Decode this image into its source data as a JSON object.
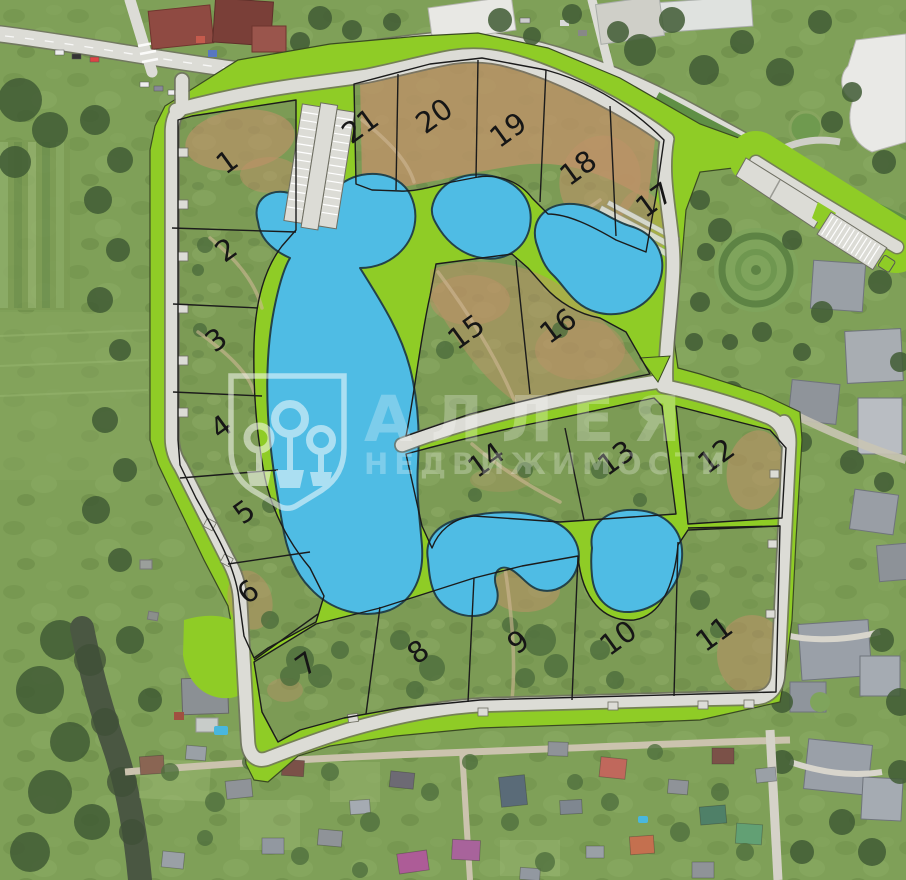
{
  "map": {
    "watermark": {
      "title": "АЛЛЕЯ",
      "subtitle": "НЕДВИЖИМОСТИ",
      "logo": "alleya-shield-trees-icon"
    },
    "number_rotation_deg": -36,
    "lots": [
      {
        "number": "1",
        "x": 233,
        "y": 170
      },
      {
        "number": "2",
        "x": 232,
        "y": 258
      },
      {
        "number": "3",
        "x": 222,
        "y": 348
      },
      {
        "number": "4",
        "x": 227,
        "y": 435
      },
      {
        "number": "5",
        "x": 250,
        "y": 520
      },
      {
        "number": "6",
        "x": 254,
        "y": 600
      },
      {
        "number": "7",
        "x": 312,
        "y": 672
      },
      {
        "number": "8",
        "x": 424,
        "y": 660
      },
      {
        "number": "9",
        "x": 524,
        "y": 650
      },
      {
        "number": "10",
        "x": 624,
        "y": 646
      },
      {
        "number": "11",
        "x": 720,
        "y": 642
      },
      {
        "number": "12",
        "x": 722,
        "y": 464
      },
      {
        "number": "13",
        "x": 622,
        "y": 466
      },
      {
        "number": "14",
        "x": 492,
        "y": 468
      },
      {
        "number": "15",
        "x": 472,
        "y": 340
      },
      {
        "number": "16",
        "x": 564,
        "y": 334
      },
      {
        "number": "17",
        "x": 660,
        "y": 208
      },
      {
        "number": "18",
        "x": 584,
        "y": 176
      },
      {
        "number": "19",
        "x": 514,
        "y": 138
      },
      {
        "number": "20",
        "x": 440,
        "y": 124
      },
      {
        "number": "21",
        "x": 366,
        "y": 134
      }
    ],
    "colors": {
      "pond": "#4FBCE4",
      "greenway": "#8FCC26",
      "road": "#DCDCD6",
      "lot_line": "#1B1B1B",
      "terrain": "#7C9B55",
      "watermark": "rgba(255,255,255,0.5)"
    }
  }
}
